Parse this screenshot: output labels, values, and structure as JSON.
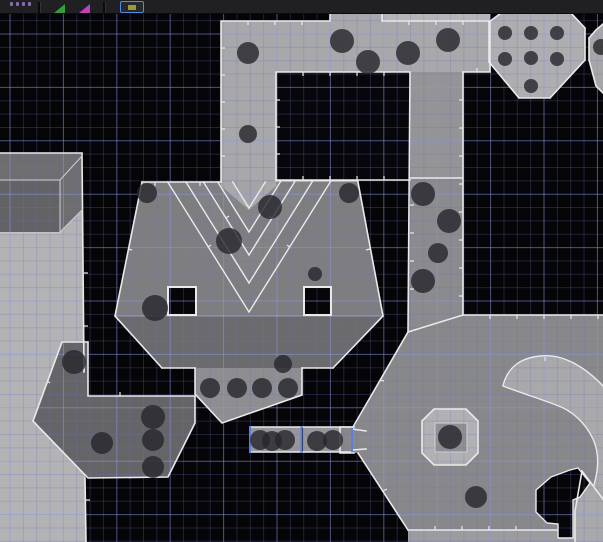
{
  "app": {
    "name": "map-editor-canvas",
    "view": "top-down sector view"
  },
  "toolbar": {
    "background": "#202023",
    "items": [
      {
        "type": "dots",
        "name": "texture-swatch-icon",
        "color": "#8a6ab2"
      },
      {
        "type": "separator",
        "name": "toolbar-separator"
      },
      {
        "type": "wedge",
        "name": "green-marker-icon",
        "color": "#2fa03a"
      },
      {
        "type": "wedge",
        "name": "magenta-marker-icon",
        "color": "#c03ec0"
      },
      {
        "type": "separator",
        "name": "toolbar-separator"
      },
      {
        "type": "button",
        "name": "active-tool-button",
        "border": "#4a90e0",
        "background": "#28282c",
        "glyph_color": "#9a9a35"
      }
    ]
  },
  "canvas": {
    "width": 603,
    "height": 542,
    "background": "#050508",
    "thing_color": "#26262a",
    "thing_opacity": 0.8,
    "outline_color": "#eaeaea",
    "selection_color": "#5d7de0",
    "grid": {
      "minor_step": 13.35,
      "major_every": 4,
      "x_start": 10,
      "y_start": 7.3,
      "y_major_index": 2,
      "minor_color": "rgba(105,115,190,0.27)",
      "major_color": "rgba(140,150,225,0.55)"
    },
    "sectors": [
      {
        "name": "left-tall-room",
        "fill": "#b3b3b5",
        "points": "0,153 82,153 86,542 0,542"
      },
      {
        "name": "left-box-structure",
        "fill": "#6e6e71",
        "points": "0,153 82,153 82,210 60,232 0,232"
      },
      {
        "name": "left-box-face",
        "fill": "#636366",
        "points": "0,180 60,180 60,232 0,232"
      },
      {
        "name": "top-corridor",
        "fill": "#a8a8aa",
        "points": "221,21 490,21 490,72 276,72 276,182 221,182"
      },
      {
        "name": "top-corridor-stub",
        "fill": "#a8a8aa",
        "points": "330,13 382,13 382,21 330,21"
      },
      {
        "name": "top-corridor-upper",
        "fill": "#b5b5b7",
        "points": "382,13 490,13 490,21 382,21"
      },
      {
        "name": "dotted-octagon-room",
        "fill": "#aeaeb0",
        "points": "489,22 501,13 571,13 585,28 585,60 550,98 519,98 489,62"
      },
      {
        "name": "right-edge-sliver",
        "fill": "#a6a6a8",
        "points": "589,60 589,38 596,30 603,24 603,93 596,86"
      },
      {
        "name": "dark-rect-sector",
        "fill": "#07070b",
        "points": "276,72 410,72 410,180 276,180"
      },
      {
        "name": "right-corridor-upper",
        "fill": "#949496",
        "points": "410,72 463,72 463,178 410,178"
      },
      {
        "name": "right-corridor-lower",
        "fill": "#8b8b8d",
        "points": "410,178 463,178 463,315 408,332"
      },
      {
        "name": "central-room",
        "fill": "#7e7e81",
        "points": "142,182 358,182 383,316 115,316"
      },
      {
        "name": "central-room-band",
        "fill": "#6b6b6e",
        "points": "115,316 383,316 333,368 162,368"
      },
      {
        "name": "corridor-stripe",
        "fill": "#a4a4a6",
        "points": "221,180 276,180 276,186 249,210 221,186"
      },
      {
        "name": "chevron-band-1",
        "fill": "rgba(255,255,255,0.055)",
        "points": "217.7,182 249,232 280.3,182 265.3,182 249,208 232.7,182"
      },
      {
        "name": "chevron-band-2",
        "fill": "rgba(255,255,255,0.04)",
        "points": "185.9,182 249,283 312.1,182 294.6,182 249,255 203.4,182"
      },
      {
        "name": "pillar-hole-left",
        "fill": "#060608",
        "points": "168,287 196,287 196,315 168,315"
      },
      {
        "name": "pillar-hole-right",
        "fill": "#060608",
        "points": "304,287 331,287 331,315 304,315"
      },
      {
        "name": "south-extension",
        "fill": "#8e8e90",
        "points": "195,368 302,368 302,395 222,423 195,394"
      },
      {
        "name": "dot-box-1",
        "fill": "#97979a",
        "points": "250,427 301,427 301,452 250,452"
      },
      {
        "name": "dot-box-2",
        "fill": "#97979a",
        "points": "303,427 352,427 352,452 303,452"
      },
      {
        "name": "box-room-connector",
        "fill": "#88888a",
        "points": "352,429 366,431 366,449 352,450"
      },
      {
        "name": "bottom-right-room",
        "fill": "#88888a",
        "points": "408,332 463,315 603,315 603,530 408,530 358,453 354,453 340,453 340,427 354,427"
      },
      {
        "name": "bottom-strip",
        "fill": "#9c9c9e",
        "points": "408,530 603,530 603,542 408,542"
      },
      {
        "name": "curved-ledge",
        "fill": "#a9a9ab",
        "path": "M503,386 C507,368 520,358 540,356 C565,353 588,370 603,386 L603,497 L594,485 C599,468 599,452 593,439 C585,422 571,410 556,405 C541,399 518,392 503,386 Z"
      },
      {
        "name": "corner-ledge",
        "fill": "#a9a9ab",
        "points": "582,471 603,499 603,542 575,542 575,511"
      },
      {
        "name": "pedestal-octagon",
        "fill": "#b1b1b3",
        "points": "434,409 466,409 478,421 478,453 466,465 434,465 422,453 422,421"
      },
      {
        "name": "pedestal-top",
        "fill": "#8f8f92",
        "points": "435,423 467,423 467,452 435,452"
      },
      {
        "name": "hook-void",
        "fill": "#060609",
        "path": "M551,477 L570,470 L578,468 L590,483 L580,497 L573,500 L573,538 L558,538 L558,524 L547,523 L536,512 L536,490 Z"
      },
      {
        "name": "southwest-corridor",
        "fill": "#656568",
        "points": "62,342 88,342 88,396 195,396 195,423 168,477 88,478 33,421"
      }
    ],
    "outlines": [
      {
        "d": "M0,153 H82 M82,153 L84,372 M85,478 L86,542"
      },
      {
        "d": "M0,180 H60 M60,180 L82,156 M60,232 L82,210 M60,180 V232 M0,233 H60",
        "c": "#cfcfd2",
        "w": 1
      },
      {
        "d": "M221,21 H330 M382,21 H490 M330,13 V21 M382,13 V21 M221,21 V182 M490,21 V72 M463,72 H490"
      },
      {
        "d": "M276,72 H410 M276,72 V180 M276,180 H410 M410,72 L408,332 M463,72 V315 M410,178 H463"
      },
      {
        "d": "M489,22 L501,13 M571,13 L585,28 M585,28 V60 M489,22 V62 M489,62 L519,98 M519,98 H550 M550,98 L585,60"
      },
      {
        "d": "M589,38 V60 M589,38 L596,30 L603,24 M589,60 L596,86 L603,93"
      },
      {
        "d": "M142,182 H221 M276,181 H358 M142,182 L115,316 M358,182 L383,316 M115,316 L162,368 M383,316 L333,368 M162,368 H195 M302,368 H333"
      },
      {
        "d": "M115,316 H383",
        "c": "rgba(255,255,255,0.3)",
        "w": 1
      },
      {
        "d": "M167.7,182 L249,312 L330.3,182",
        "w": 1.4
      },
      {
        "d": "M185.9,182 L249,283 L312.1,182",
        "w": 1.4
      },
      {
        "d": "M203.4,182 L249,255 L294.6,182",
        "w": 1.4
      },
      {
        "d": "M217.7,182 L249,232 L280.3,182",
        "w": 1.4
      },
      {
        "d": "M232.7,182 L249,208 L265.3,182",
        "w": 1.4
      },
      {
        "d": "M168,287 H196 V315 H168 Z M304,287 H331 V315 H304 Z",
        "w": 2
      },
      {
        "d": "M195,368 V394 L222,423 L302,395 V368"
      },
      {
        "d": "M250,427 H352 M250,452 H352 M352,429 L366,431 M352,450 L366,449"
      },
      {
        "d": "M250,427 V452 M301.5,427 V452 M352,427 V452",
        "c": "#5d7de0",
        "w": 2
      },
      {
        "d": "M408,332 L463,315 H603 M408,332 L353,427 M354,427 H340 V453 H354 M358,453 L408,530 M408,530 H557"
      },
      {
        "d": "M422,421 L434,409 H466 L478,421 V453 L466,465 H434 L422,453 Z"
      },
      {
        "d": "M435,423 H467 V452 H435 Z",
        "c": "#d0d0d3",
        "w": 1
      },
      {
        "d": "M503,386 C507,368 520,358 540,356 C565,353 588,370 603,386 M503,386 C518,392 541,399 556,405 C571,410 585,422 593,439 C599,452 599,468 594,485",
        "w": 1.4
      },
      {
        "d": "M582,471 L603,499 M575,542 V511 L582,471"
      },
      {
        "d": "M551,477 L570,470 L578,468 L590,483 L580,497 L573,500 L573,538 L558,538 L558,524 L547,523 L536,512 L536,490 Z",
        "w": 1.4
      },
      {
        "d": "M62,342 H88 V396 H195 V423 L168,477 L88,478 L33,421 Z"
      }
    ],
    "ticks": [
      [
        463,
        100,
        -4,
        0
      ],
      [
        463,
        128,
        -4,
        0
      ],
      [
        463,
        156,
        -4,
        0
      ],
      [
        463,
        184,
        -4,
        0
      ],
      [
        463,
        212,
        -4,
        0
      ],
      [
        463,
        240,
        -4,
        0
      ],
      [
        463,
        268,
        -4,
        0
      ],
      [
        463,
        296,
        -4,
        0
      ],
      [
        410,
        205,
        4,
        0
      ],
      [
        410,
        233,
        4,
        0
      ],
      [
        410,
        261,
        4,
        0
      ],
      [
        410,
        289,
        4,
        0
      ],
      [
        276,
        100,
        4,
        0
      ],
      [
        276,
        127,
        4,
        0
      ],
      [
        276,
        154,
        4,
        0
      ],
      [
        303,
        72,
        0,
        4
      ],
      [
        330,
        72,
        0,
        4
      ],
      [
        357,
        72,
        0,
        4
      ],
      [
        384,
        72,
        0,
        4
      ],
      [
        303,
        180,
        0,
        -4
      ],
      [
        330,
        180,
        0,
        -4
      ],
      [
        357,
        180,
        0,
        -4
      ],
      [
        384,
        180,
        0,
        -4
      ],
      [
        248,
        21,
        0,
        4
      ],
      [
        275,
        21,
        0,
        4
      ],
      [
        302,
        21,
        0,
        4
      ],
      [
        409,
        21,
        0,
        4
      ],
      [
        436,
        21,
        0,
        4
      ],
      [
        463,
        21,
        0,
        4
      ],
      [
        221,
        48,
        4,
        0
      ],
      [
        221,
        75,
        4,
        0
      ],
      [
        221,
        102,
        4,
        0
      ],
      [
        221,
        129,
        4,
        0
      ],
      [
        221,
        156,
        4,
        0
      ],
      [
        155,
        182,
        0,
        4
      ],
      [
        200,
        182,
        0,
        4
      ],
      [
        128,
        249,
        4,
        1
      ],
      [
        370,
        249,
        -4,
        1
      ],
      [
        490,
        315,
        0,
        4
      ],
      [
        517,
        315,
        0,
        4
      ],
      [
        544,
        315,
        0,
        4
      ],
      [
        571,
        315,
        0,
        4
      ],
      [
        598,
        315,
        0,
        4
      ],
      [
        380,
        380,
        4,
        1
      ],
      [
        383,
        491,
        4,
        -2
      ],
      [
        435,
        530,
        0,
        -4
      ],
      [
        462,
        530,
        0,
        -4
      ],
      [
        489,
        530,
        0,
        -4
      ],
      [
        516,
        530,
        0,
        -4
      ],
      [
        84,
        273,
        4,
        0
      ],
      [
        84,
        326,
        4,
        0
      ],
      [
        86,
        500,
        4,
        0
      ],
      [
        208,
        247,
        3,
        -2
      ],
      [
        290,
        247,
        -3,
        -2
      ],
      [
        226,
        218,
        3,
        -2
      ],
      [
        272,
        218,
        -3,
        -2
      ],
      [
        47,
        381,
        3,
        2
      ],
      [
        120,
        396,
        0,
        -4
      ],
      [
        477,
        72,
        0,
        -4
      ],
      [
        545,
        357,
        0,
        4
      ]
    ],
    "things": [
      {
        "x": 248,
        "y": 53,
        "r": 11
      },
      {
        "x": 342,
        "y": 41,
        "r": 12
      },
      {
        "x": 368,
        "y": 62,
        "r": 12
      },
      {
        "x": 408,
        "y": 53,
        "r": 12
      },
      {
        "x": 448,
        "y": 40,
        "r": 12
      },
      {
        "x": 248,
        "y": 134,
        "r": 9
      },
      {
        "x": 505,
        "y": 33,
        "r": 7
      },
      {
        "x": 531,
        "y": 33,
        "r": 7
      },
      {
        "x": 557,
        "y": 33,
        "r": 7
      },
      {
        "x": 505,
        "y": 59,
        "r": 7
      },
      {
        "x": 531,
        "y": 58,
        "r": 7
      },
      {
        "x": 557,
        "y": 59,
        "r": 7
      },
      {
        "x": 531,
        "y": 86,
        "r": 7
      },
      {
        "x": 601,
        "y": 47,
        "r": 8
      },
      {
        "x": 423,
        "y": 194,
        "r": 12
      },
      {
        "x": 449,
        "y": 221,
        "r": 12
      },
      {
        "x": 438,
        "y": 253,
        "r": 10
      },
      {
        "x": 423,
        "y": 281,
        "r": 12
      },
      {
        "x": 147,
        "y": 193,
        "r": 10
      },
      {
        "x": 349,
        "y": 193,
        "r": 10
      },
      {
        "x": 270,
        "y": 207,
        "r": 12
      },
      {
        "x": 229,
        "y": 241,
        "r": 13
      },
      {
        "x": 315,
        "y": 274,
        "r": 7
      },
      {
        "x": 155,
        "y": 308,
        "r": 13
      },
      {
        "x": 283,
        "y": 364,
        "r": 9
      },
      {
        "x": 210,
        "y": 388,
        "r": 10
      },
      {
        "x": 237,
        "y": 388,
        "r": 10
      },
      {
        "x": 262,
        "y": 388,
        "r": 10
      },
      {
        "x": 288,
        "y": 388,
        "r": 10
      },
      {
        "x": 260,
        "y": 440,
        "r": 10
      },
      {
        "x": 272,
        "y": 441,
        "r": 10
      },
      {
        "x": 285,
        "y": 440,
        "r": 10
      },
      {
        "x": 317,
        "y": 441,
        "r": 10
      },
      {
        "x": 333,
        "y": 440,
        "r": 10
      },
      {
        "x": 74,
        "y": 362,
        "r": 12
      },
      {
        "x": 102,
        "y": 443,
        "r": 11
      },
      {
        "x": 153,
        "y": 417,
        "r": 12
      },
      {
        "x": 153,
        "y": 440,
        "r": 11
      },
      {
        "x": 153,
        "y": 467,
        "r": 11
      },
      {
        "x": 450,
        "y": 437,
        "r": 12
      },
      {
        "x": 476,
        "y": 497,
        "r": 11
      }
    ]
  }
}
